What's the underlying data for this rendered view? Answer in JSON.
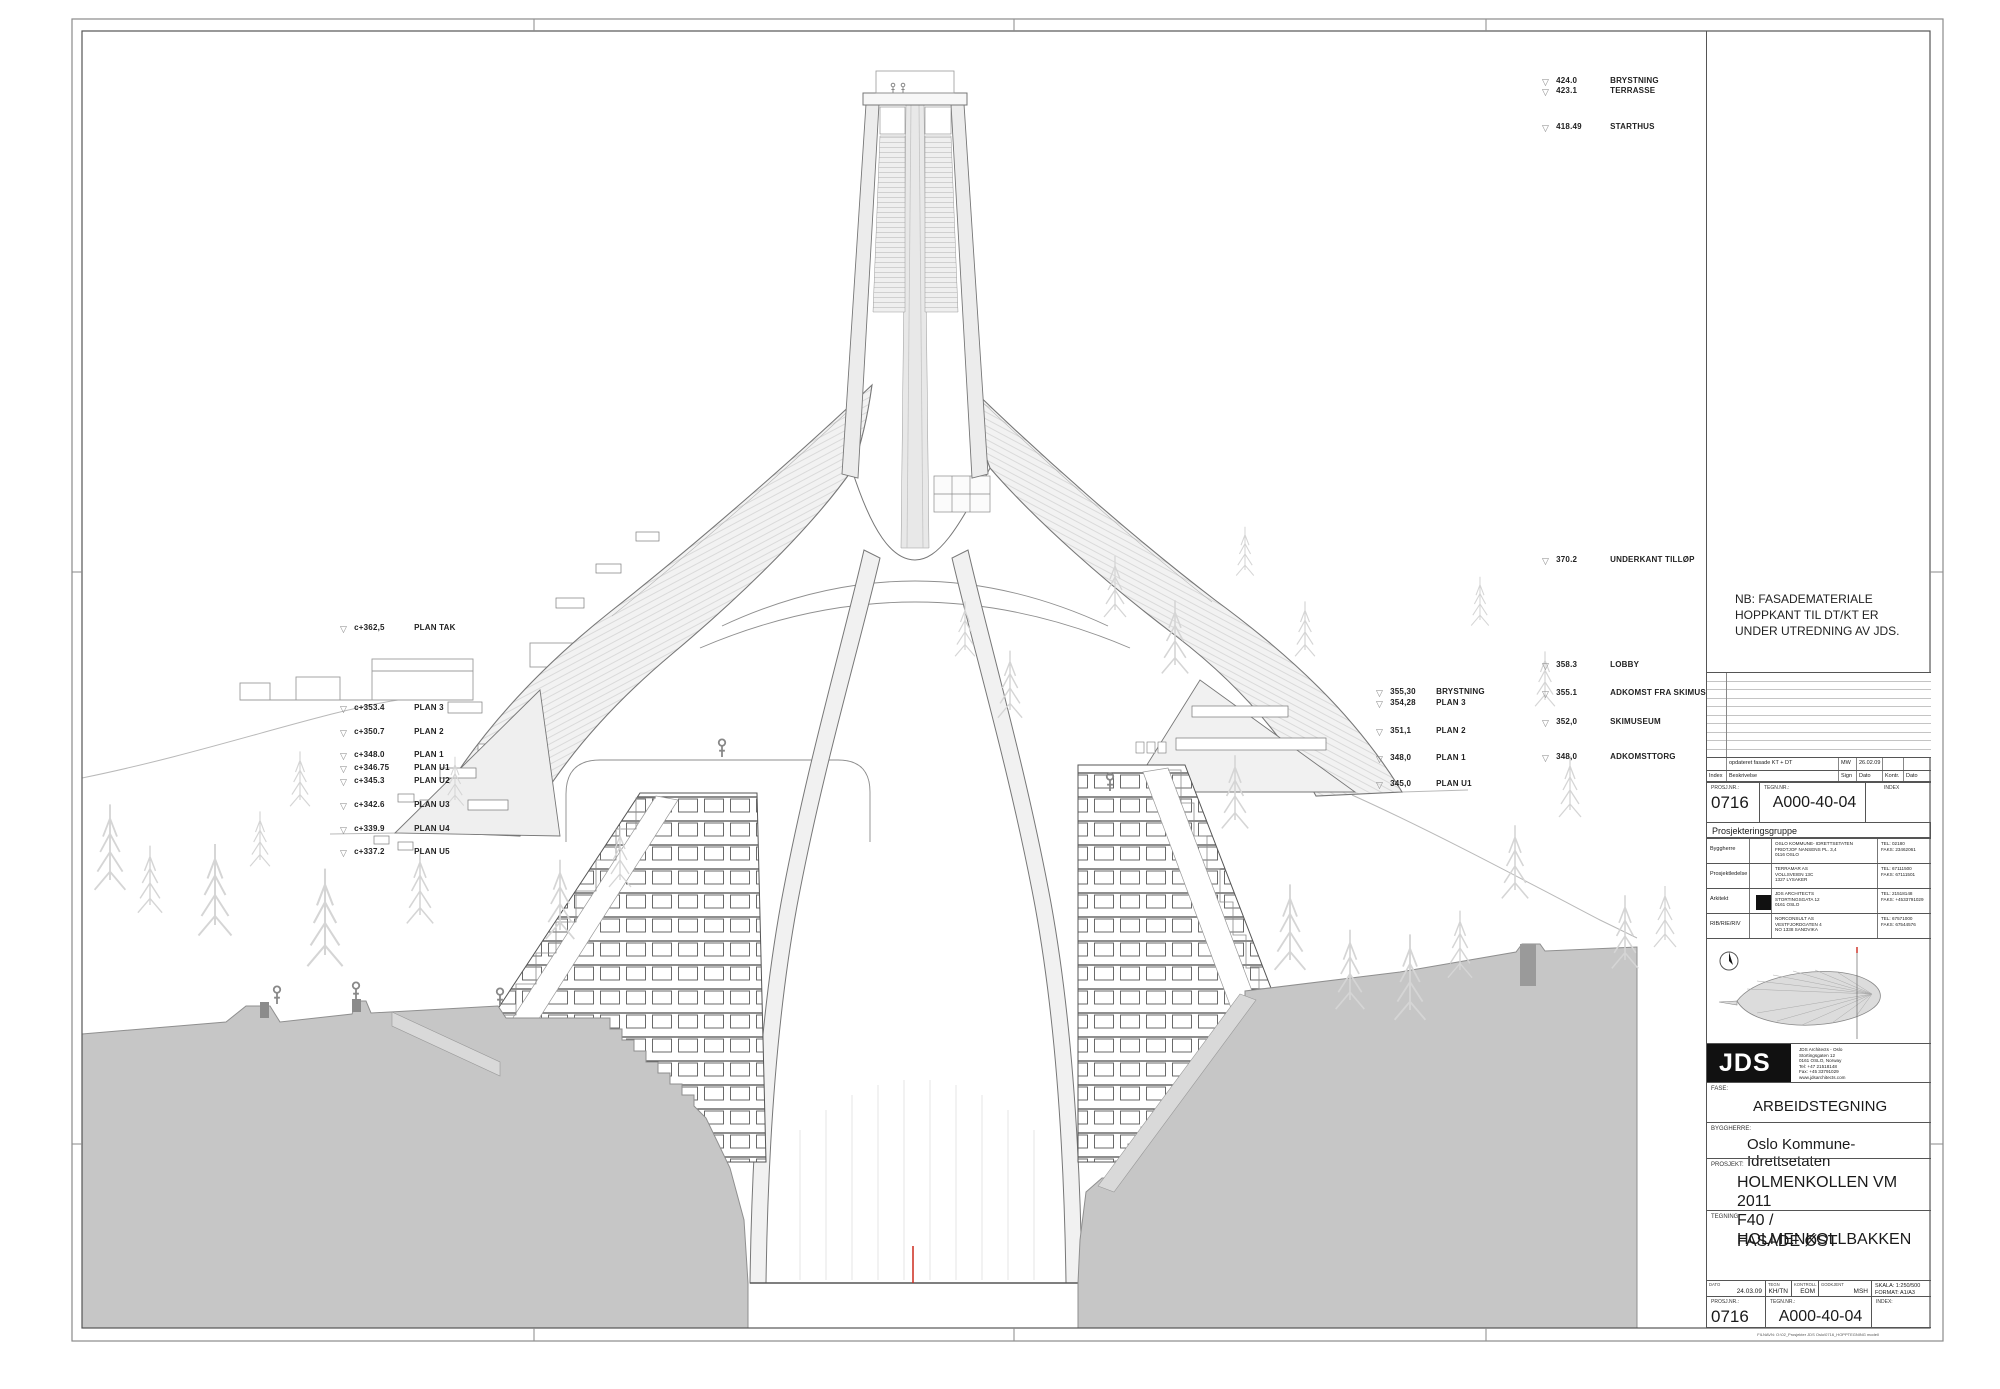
{
  "annotations": {
    "left": [
      {
        "value": "c+362,5",
        "label": "PLAN TAK"
      },
      {
        "value": "c+353.4",
        "label": "PLAN 3"
      },
      {
        "value": "c+350.7",
        "label": "PLAN 2"
      },
      {
        "value": "c+348.0",
        "label": "PLAN 1"
      },
      {
        "value": "c+346.75",
        "label": "PLAN U1"
      },
      {
        "value": "c+345.3",
        "label": "PLAN U2"
      },
      {
        "value": "c+342.6",
        "label": "PLAN U3"
      },
      {
        "value": "c+339.9",
        "label": "PLAN U4"
      },
      {
        "value": "c+337.2",
        "label": "PLAN U5"
      }
    ],
    "center": [
      {
        "value": "355,30",
        "label": "BRYSTNING"
      },
      {
        "value": "354,28",
        "label": "PLAN 3"
      },
      {
        "value": "351,1",
        "label": "PLAN 2"
      },
      {
        "value": "348,0",
        "label": "PLAN 1"
      },
      {
        "value": "345,0",
        "label": "PLAN U1"
      }
    ],
    "right": [
      {
        "value": "424.0",
        "label": "BRYSTNING"
      },
      {
        "value": "423.1",
        "label": "TERRASSE"
      },
      {
        "value": "418.49",
        "label": "STARTHUS"
      },
      {
        "value": "370.2",
        "label": "UNDERKANT TILLØP"
      },
      {
        "value": "358.3",
        "label": "LOBBY"
      },
      {
        "value": "355.1",
        "label": "ADKOMST FRA SKIMUSEUM"
      },
      {
        "value": "352,0",
        "label": "SKIMUSEUM"
      },
      {
        "value": "348,0",
        "label": "ADKOMSTTORG"
      }
    ]
  },
  "note": {
    "line1": "NB: FASADEMATERIALE",
    "line2": "HOPPKANT TIL DT/KT ER",
    "line3": "UNDER UTREDNING AV JDS."
  },
  "revision": {
    "row": {
      "description": "opdateret fasade KT + DT",
      "sign": "MW",
      "date": "26.02.09"
    },
    "header": {
      "index": "Index",
      "description": "Beskrivelse",
      "sign": "Sign",
      "date": "Dato",
      "kontr": "Kontr.",
      "date2": "Dato"
    }
  },
  "ids": {
    "prosj_label": "PROSJ.NR.:",
    "prosj": "0716",
    "tegn_label": "TEGN.NR.:",
    "tegn": "A000-40-04",
    "index_label": "INDEX",
    "index_label2": "INDEX:"
  },
  "group": {
    "title": "Prosjekteringsgruppe",
    "tel_label": "TEL:",
    "faks_label": "FAKS:",
    "rows": [
      {
        "role": "Byggherre",
        "l1": "OSLO KOMMUNE- IDRETTSETATEN",
        "l2": "FRIDTJOF NANSENS PL. 3,4",
        "l3": "0116 OSLO",
        "tel": "02180",
        "faks": "23462061"
      },
      {
        "role": "Prosjektledelse",
        "l1": "TERRAMAR AS",
        "l2": "VOLLSVEIEN 13C",
        "l3": "1327 LYSAKER",
        "tel": "67111500",
        "faks": "67111501"
      },
      {
        "role": "Arkitekt",
        "l1": "JDS ARCHITECTS",
        "l2": "STORTINGSGATA 12",
        "l3": "0161 OSLO",
        "tel": "21518148",
        "faks": "+4533791029"
      },
      {
        "role": "RIB/RIE/RIV",
        "l1": "NORCONSULT AS",
        "l2": "VESTFJORDGATEN 4",
        "l3": "NO 1338 SANDVIKA",
        "tel": "67571000",
        "faks": "67544576"
      }
    ]
  },
  "logo": {
    "text": "JDS",
    "a1": "JDS Architects - Oslo",
    "a2": "Stortingsgaten 12",
    "a3": "0161 OSLO, Norway",
    "a4": "Tel: +47 21518148",
    "a5": "Fax: +45 33791029",
    "a6": "www.jdsarchitects.com"
  },
  "fields": {
    "fase_label": "FASE:",
    "fase": "ARBEIDSTEGNING",
    "byggherre_label": "BYGGHERRE:",
    "byggherre": "Oslo Kommune-Idrettsetaten",
    "prosjekt_label": "PROSJEKT:",
    "prosjekt1": "HOLMENKOLLEN VM 2011",
    "prosjekt2": "F40 / HOLMENKOLLBAKKEN",
    "tegning_label": "TEGNING:",
    "tegning": "FASADE ØST"
  },
  "infobar": {
    "dato_label": "DATO",
    "dato": "24.03.09",
    "tegn_label": "TEGN",
    "tegn": "KH/TN",
    "kontroll_label": "KONTROLL",
    "kontroll": "EOM",
    "godkjent_label": "GODKJENT",
    "godkjent": "MSH",
    "skala_label": "SKALA:",
    "skala": "1:250/500",
    "format_label": "FORMAT:",
    "format": "A1/A3"
  },
  "footer": {
    "filename": "FILNAVN: O:\\02_Prosjekter JDS Oslo\\0716_HOPPTEGNING modell"
  },
  "colors": {
    "accent_red": "#cc2a1e",
    "ground_gray": "#c6c6c6",
    "line_gray": "#777777"
  }
}
